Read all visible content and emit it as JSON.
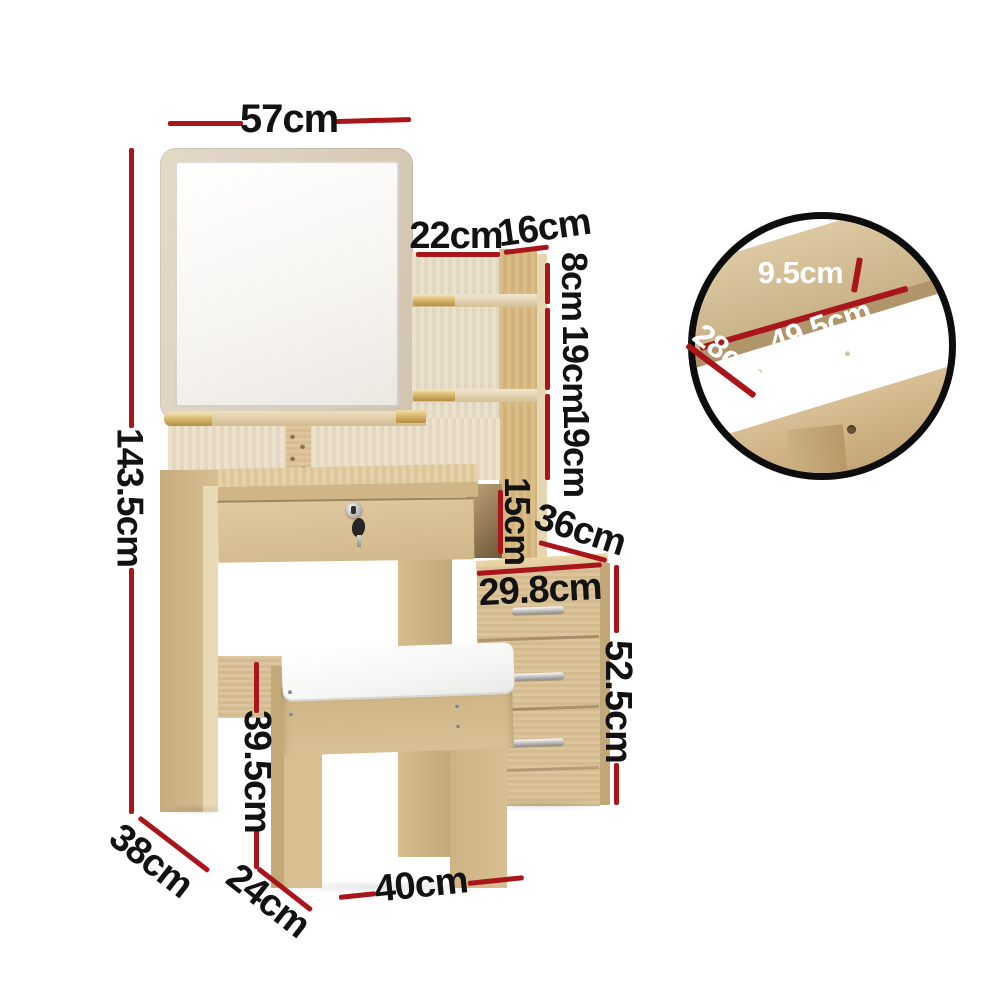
{
  "title": "Dressing table with mirror, shelves, stool and drawer cabinet - dimension diagram",
  "dims": {
    "mirror_width": "57cm",
    "overall_height": "143.5cm",
    "shelf_span_left": "22cm",
    "shelf_span_right": "16cm",
    "gap_top": "8cm",
    "gap_mid": "19cm",
    "gap_low": "19cm",
    "cube_height": "15cm",
    "cabinet_top_depth": "36cm",
    "cabinet_width": "29.8cm",
    "cabinet_height": "52.5cm",
    "stool_height": "39.5cm",
    "table_depth": "38cm",
    "stool_depth": "24cm",
    "stool_width": "40cm"
  },
  "inset_dims": {
    "drawer_depth": "9.5cm",
    "drawer_length": "49.5cm",
    "drawer_width": "28cm"
  },
  "colors": {
    "dimension_line": "#a8151b",
    "label_text": "#121212",
    "inset_label_text": "#ffffff",
    "gold_trim": "#cfa75f"
  }
}
